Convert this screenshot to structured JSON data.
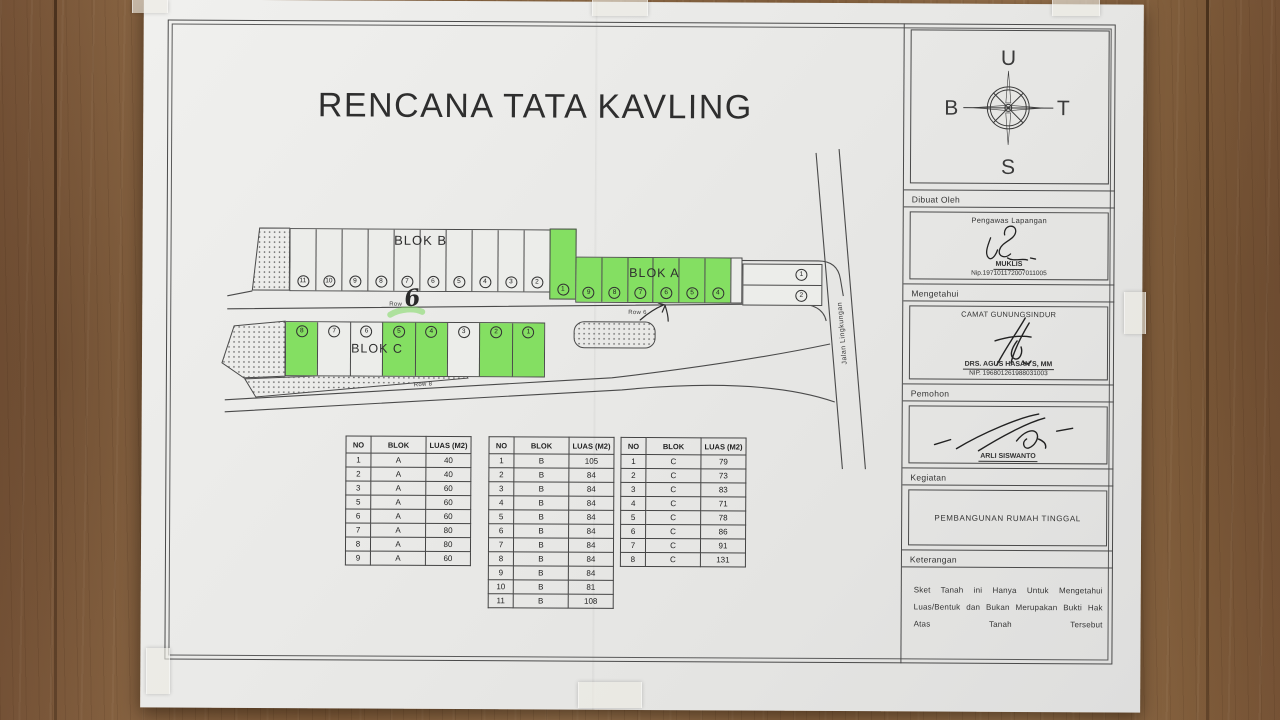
{
  "title": "RENCANA TATA KAVLING",
  "compass": {
    "north": "U",
    "south": "S",
    "west": "B",
    "east": "T"
  },
  "map": {
    "blok_b": {
      "label": "BLOK B",
      "row_label": "Row",
      "row_hand": "6",
      "plots": [
        {
          "no": "11"
        },
        {
          "no": "10"
        },
        {
          "no": "9"
        },
        {
          "no": "8"
        },
        {
          "no": "7"
        },
        {
          "no": "6"
        },
        {
          "no": "5"
        },
        {
          "no": "4"
        },
        {
          "no": "3"
        },
        {
          "no": "2"
        }
      ],
      "green_plot": {
        "no": "1"
      }
    },
    "blok_a": {
      "label": "BLOK A",
      "row_label": "Row 6",
      "plots": [
        {
          "no": "9",
          "green": true
        },
        {
          "no": "8",
          "green": true
        },
        {
          "no": "7",
          "green": true
        },
        {
          "no": "6",
          "green": true
        },
        {
          "no": "5",
          "green": true
        },
        {
          "no": "4",
          "green": true
        }
      ],
      "side_plots": [
        "1",
        "2"
      ]
    },
    "blok_c": {
      "label": "BLOK C",
      "row_label": "Row 8",
      "plots": [
        {
          "no": "8",
          "green": true
        },
        {
          "no": "7"
        },
        {
          "no": "6"
        },
        {
          "no": "5",
          "green": true
        },
        {
          "no": "4",
          "green": true
        },
        {
          "no": "3"
        },
        {
          "no": "2",
          "green": true
        },
        {
          "no": "1",
          "green": true
        }
      ]
    },
    "road_label": "Jalan Lingkungan"
  },
  "tables": [
    {
      "headers": [
        "NO",
        "BLOK",
        "LUAS (M2)"
      ],
      "rows": [
        [
          "1",
          "A",
          "40"
        ],
        [
          "2",
          "A",
          "40"
        ],
        [
          "3",
          "A",
          "60"
        ],
        [
          "5",
          "A",
          "60"
        ],
        [
          "6",
          "A",
          "60"
        ],
        [
          "7",
          "A",
          "80"
        ],
        [
          "8",
          "A",
          "80"
        ],
        [
          "9",
          "A",
          "60"
        ]
      ]
    },
    {
      "headers": [
        "NO",
        "BLOK",
        "LUAS (M2)"
      ],
      "rows": [
        [
          "1",
          "B",
          "105"
        ],
        [
          "2",
          "B",
          "84"
        ],
        [
          "3",
          "B",
          "84"
        ],
        [
          "4",
          "B",
          "84"
        ],
        [
          "5",
          "B",
          "84"
        ],
        [
          "6",
          "B",
          "84"
        ],
        [
          "7",
          "B",
          "84"
        ],
        [
          "8",
          "B",
          "84"
        ],
        [
          "9",
          "B",
          "84"
        ],
        [
          "10",
          "B",
          "81"
        ],
        [
          "11",
          "B",
          "108"
        ]
      ]
    },
    {
      "headers": [
        "NO",
        "BLOK",
        "LUAS (M2)"
      ],
      "rows": [
        [
          "1",
          "C",
          "79"
        ],
        [
          "2",
          "C",
          "73"
        ],
        [
          "3",
          "C",
          "83"
        ],
        [
          "4",
          "C",
          "71"
        ],
        [
          "5",
          "C",
          "78"
        ],
        [
          "6",
          "C",
          "86"
        ],
        [
          "7",
          "C",
          "91"
        ],
        [
          "8",
          "C",
          "131"
        ]
      ]
    }
  ],
  "sidebar": {
    "dibuat_oleh": {
      "header": "Dibuat Oleh",
      "role": "Pengawas Lapangan",
      "name": "MUKLIS",
      "nip": "Nip.197101172007011005"
    },
    "mengetahui": {
      "header": "Mengetahui",
      "role": "CAMAT GUNUNGSINDUR",
      "name": "DRS. AGUS HASAN S, MM",
      "nip": "NIP. 196801261988031003"
    },
    "pemohon": {
      "header": "Pemohon",
      "name": "ARLI SISWANTO"
    },
    "kegiatan": {
      "header": "Kegiatan",
      "content": "PEMBANGUNAN RUMAH TINGGAL"
    },
    "keterangan": {
      "header": "Keterangan",
      "note": "Sket Tanah ini Hanya Untuk Mengetahui Luas/Bentuk dan Bukan Merupakan Bukti Hak Atas Tanah Tersebut"
    }
  },
  "colors": {
    "green_plot": "#84df62",
    "paper": "#eaeae8",
    "line": "#4a4a4a",
    "wood": "#8a6541"
  }
}
